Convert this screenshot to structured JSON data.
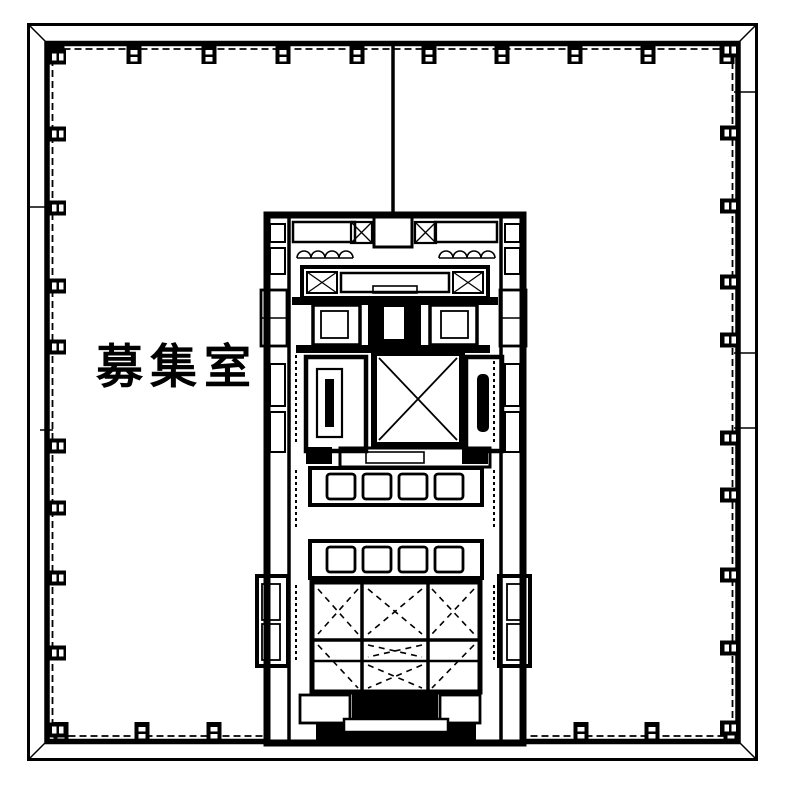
{
  "page": {
    "title": "floor-plan",
    "colors": {
      "ink": "#000000",
      "paper": "#ffffff"
    }
  },
  "floor_plan": {
    "room_label": "募集室"
  }
}
